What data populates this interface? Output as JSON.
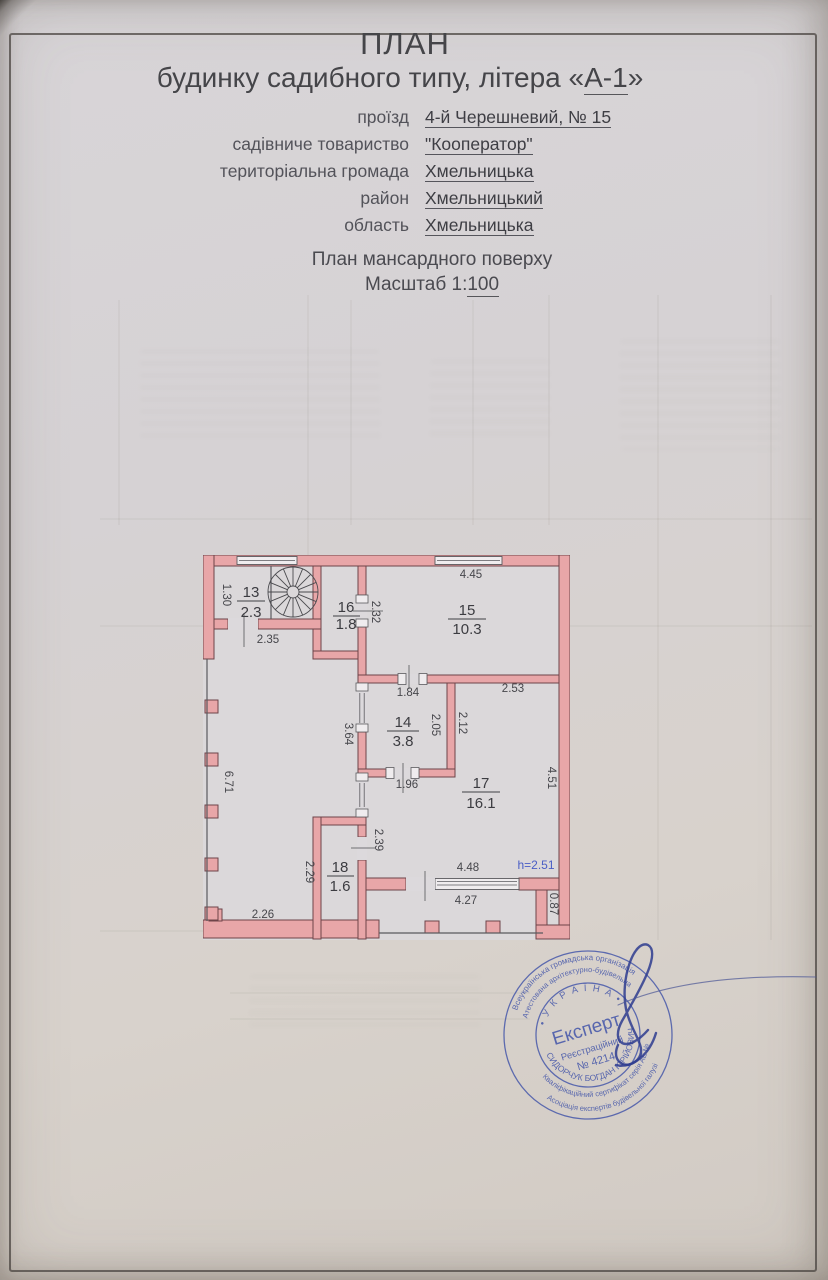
{
  "document": {
    "title": "ПЛАН",
    "title_line2_prefix": "будинку садибного типу, літера «",
    "title_line2_value": "А-1",
    "title_line2_suffix": "»",
    "address": {
      "rows": [
        {
          "label": "проїзд",
          "value": "4-й Черешневий, № 15"
        },
        {
          "label": "садівниче товариство",
          "value": "\"Кооператор\""
        },
        {
          "label": "територіальна громада",
          "value": "Хмельницька"
        },
        {
          "label": "район",
          "value": "Хмельницький"
        },
        {
          "label": "область",
          "value": "Хмельницька"
        }
      ]
    },
    "plan_caption": "План мансардного поверху",
    "scale_label": "Масштаб 1:",
    "scale_value": "100"
  },
  "floorplan": {
    "rooms": [
      {
        "number": "13",
        "area": "2.3"
      },
      {
        "number": "14",
        "area": "3.8"
      },
      {
        "number": "15",
        "area": "10.3"
      },
      {
        "number": "16",
        "area": "1.8"
      },
      {
        "number": "17",
        "area": "16.1"
      },
      {
        "number": "18",
        "area": "1.6"
      }
    ],
    "dimensions": {
      "room13_left": "1.30",
      "room13_bottom": "2.35",
      "room15_top": "4.45",
      "room16_right": "2.32",
      "room14_top": "1.84",
      "room14_inner_right": "2.05",
      "room17_left": "2.12",
      "room17_top": "2.53",
      "room17_right": "4.51",
      "room14_bottom": "1.96",
      "mid_wall_left": "3.64",
      "open_area_left": "6.71",
      "room18_left": "2.29",
      "room18_right": "2.39",
      "open_area_bottom": "2.26",
      "window_top": "4.48",
      "window_bottom": "4.27",
      "corner_right": "0.87",
      "ceiling_height": "h=2.51"
    },
    "colors": {
      "wall_fill": "#e8a6a8",
      "wall_stroke": "#6e4449",
      "height_note": "#4a5ec5"
    }
  },
  "stamp": {
    "ring_top_outer": "Всеукраїнська громадська організація",
    "ring_top_inner": "Атестована архітектурно-будівельна",
    "country": "• У К Р А Ї Н А •",
    "center_role": "Експерт",
    "center_reg_label": "Реєстраційний",
    "center_reg_number": "№ 4214",
    "name_arc": "СИДОРЧУК БОГДАН ЮРІЙОВИЧ",
    "ring_bottom_middle": "Кваліфікаційний сертифікат серія АЕ №",
    "ring_bottom_outer": "Асоціація експертів будівельної галузі",
    "color": "#3d50a8"
  }
}
